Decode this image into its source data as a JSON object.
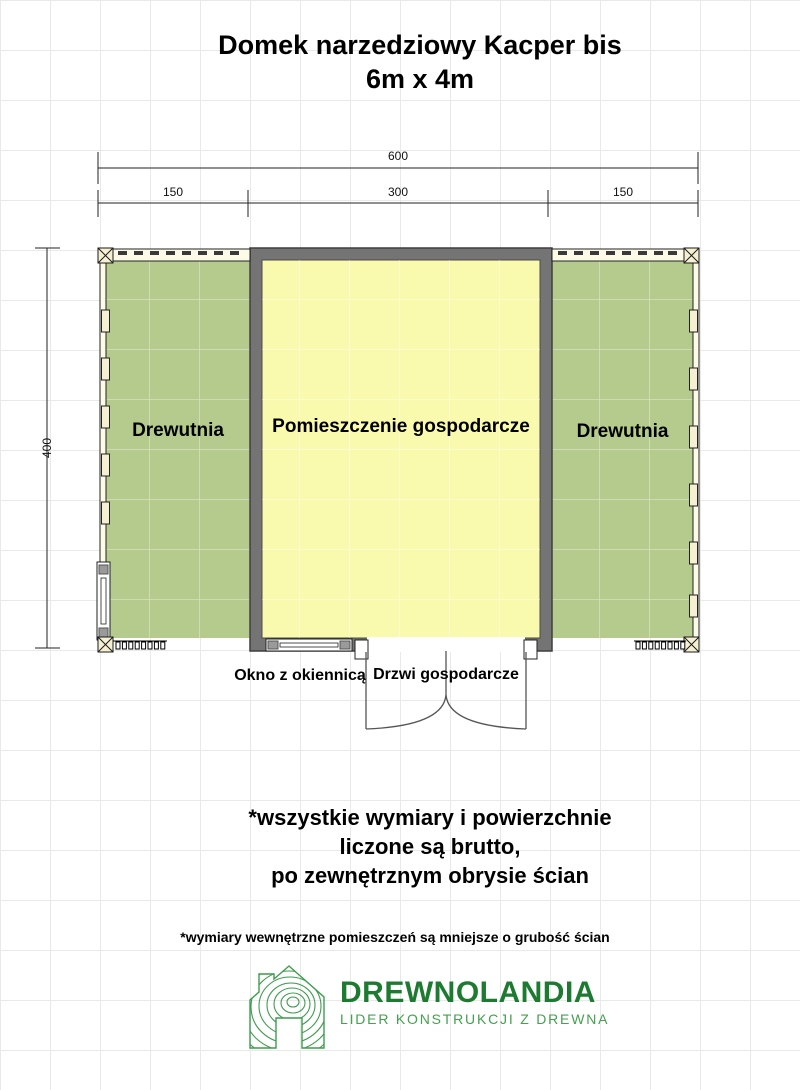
{
  "title": {
    "line1": "Domek narzedziowy Kacper bis",
    "line2": "6m x 4m"
  },
  "dims": {
    "total": "600",
    "seg_left": "150",
    "seg_center": "300",
    "seg_right": "150",
    "height": "400"
  },
  "rooms": {
    "left": {
      "label": "Drewutnia",
      "color": "#b5cb8d"
    },
    "center": {
      "label": "Pomieszczenie gospodarcze",
      "color": "#fafaae"
    },
    "right": {
      "label": "Drewutnia",
      "color": "#b5cb8d"
    }
  },
  "annotations": {
    "window_label": "Okno z okiennicą",
    "door_label": "Drzwi gospodarcze"
  },
  "notes": {
    "line1": "*wszystkie wymiary i powierzchnie",
    "line2": "liczone są brutto,",
    "line3": "po zewnętrznym obrysie ścian",
    "small": "*wymiary wewnętrzne pomieszczeń są mniejsze o grubość ścian"
  },
  "branding": {
    "name": "DREWNOLANDIA",
    "tagline": "LIDER KONSTRUKCJI Z DREWNA",
    "name_color": "#1d7b31",
    "tagline_color": "#43a14f",
    "icon_color": "#3f9c4f"
  },
  "colors": {
    "wall_fill": "#747474",
    "wall_outline": "#3f3f3f",
    "post_fill": "#f6f0d2",
    "frame_fill": "#fdfae8",
    "grid_line": "#e9e9e9",
    "door_swing": "#555555"
  }
}
